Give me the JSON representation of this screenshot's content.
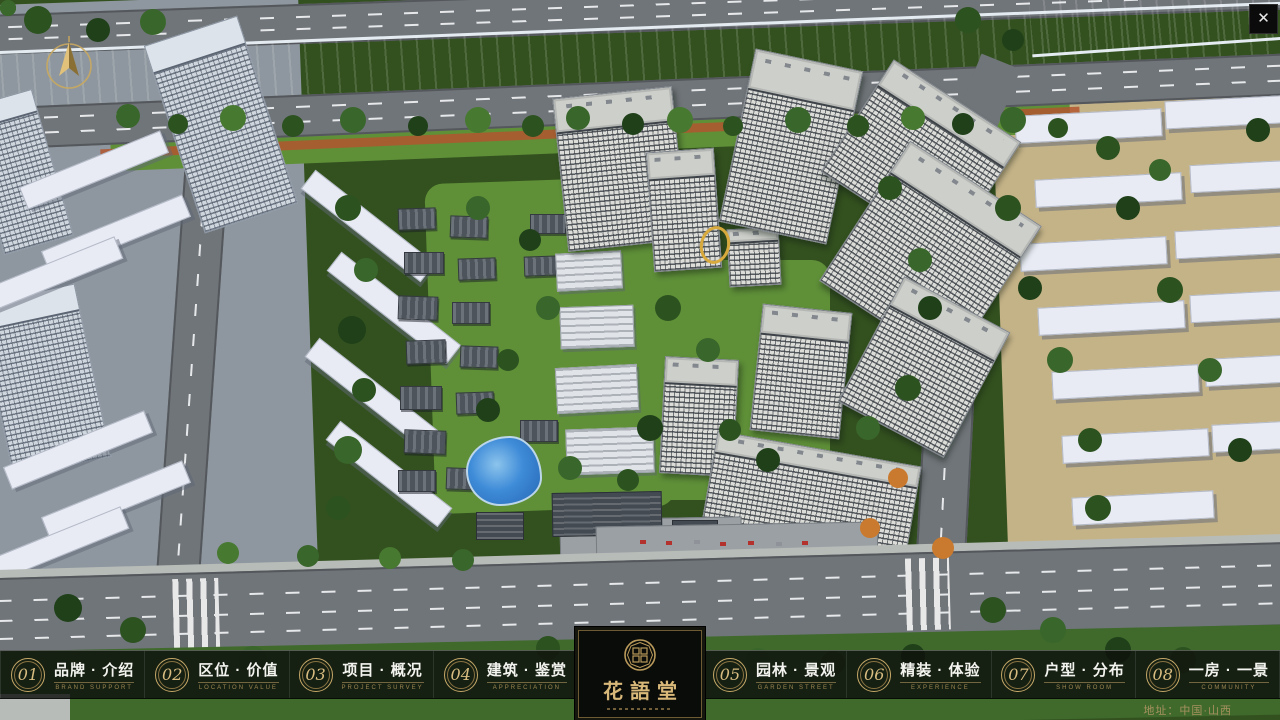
{
  "window": {
    "close_label": "✕"
  },
  "nav": {
    "items": [
      {
        "num": "01",
        "zh": "品牌 · 介绍",
        "en": "BRAND SUPPORT"
      },
      {
        "num": "02",
        "zh": "区位 · 价值",
        "en": "LOCATION VALUE"
      },
      {
        "num": "03",
        "zh": "项目 · 概况",
        "en": "PROJECT SURVEY"
      },
      {
        "num": "04",
        "zh": "建筑 · 鉴赏",
        "en": "APPRECIATION"
      },
      {
        "num": "05",
        "zh": "园林 · 景观",
        "en": "GARDEN STREET"
      },
      {
        "num": "06",
        "zh": "精装 · 体验",
        "en": "EXPERIENCE"
      },
      {
        "num": "07",
        "zh": "户型 · 分布",
        "en": "SHOW ROOM"
      },
      {
        "num": "08",
        "zh": "一房 · 一景",
        "en": "COMMUNITY"
      }
    ]
  },
  "logo": {
    "title": "花語堂"
  },
  "footer": {
    "address": "地址：中国·山西"
  },
  "colors": {
    "gold": "#c5a868",
    "bar_bg": "rgba(13,16,12,0.82)",
    "river_blue": "#1e4fae"
  }
}
